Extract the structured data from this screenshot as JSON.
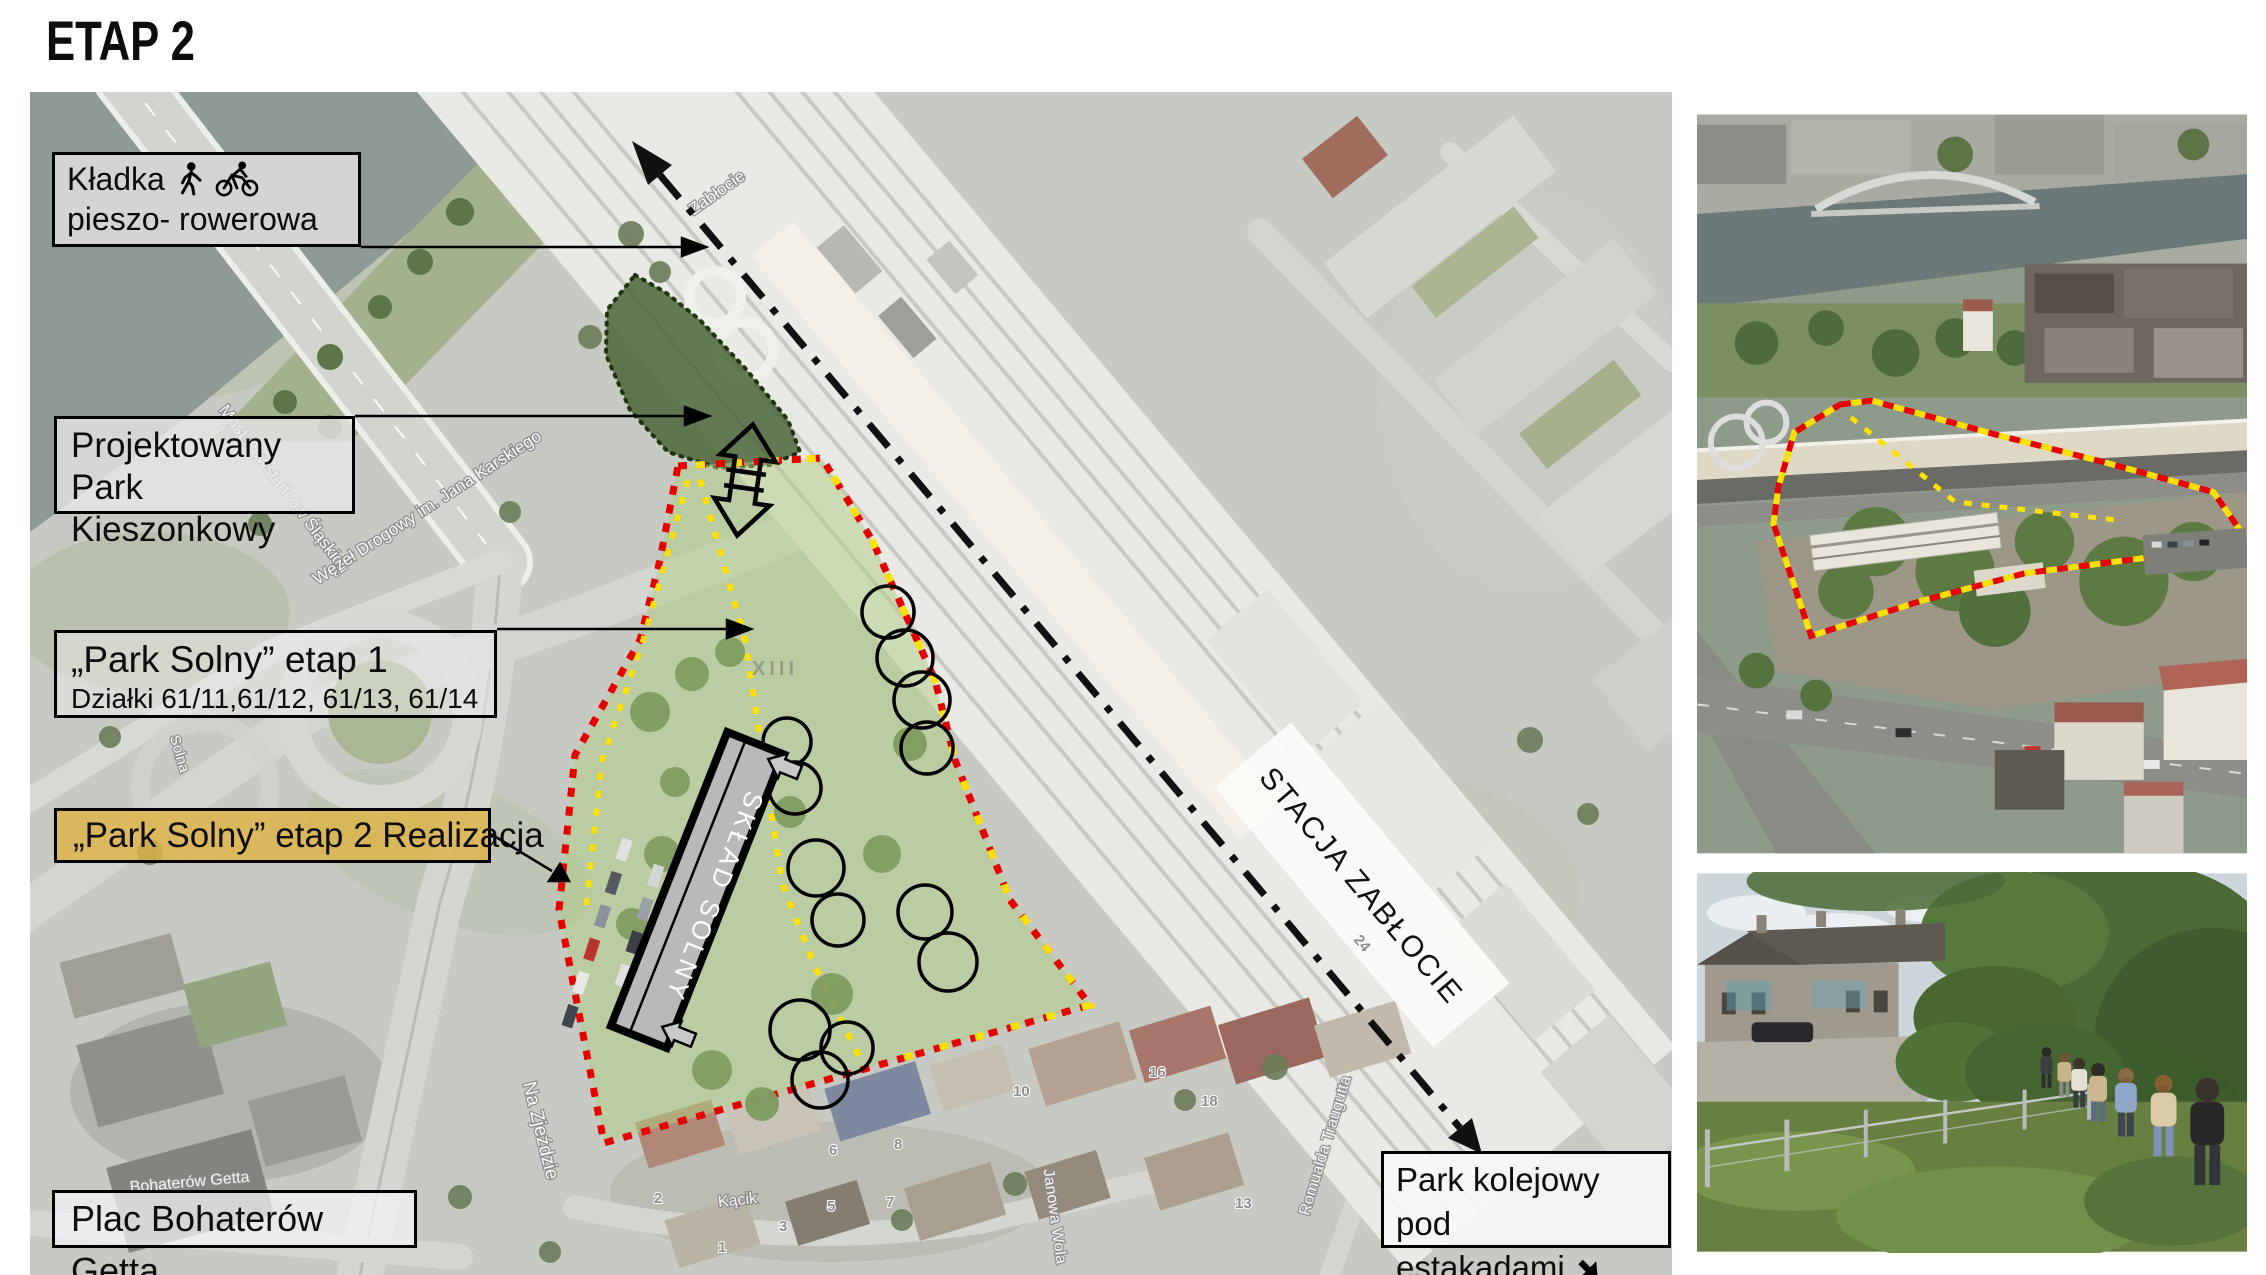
{
  "title": "ETAP 2",
  "map": {
    "labels": {
      "kladka": {
        "line1": "Kładka",
        "line2": "pieszo- rowerowa",
        "icons": [
          "pedestrian-icon",
          "cyclist-icon"
        ]
      },
      "pocket_park": {
        "line1": "Projektowany",
        "line2": "Park Kieszonkowy"
      },
      "etap1": {
        "line1": "„Park Solny” etap 1",
        "line2": "Działki 61/11,61/12, 61/13, 61/14"
      },
      "etap2": {
        "text": "„Park Solny” etap 2 Realizacja"
      },
      "plac": {
        "text": "Plac Bohaterów Getta"
      },
      "park_kolejowy": {
        "line1": "Park kolejowy pod",
        "line2": "estakadami",
        "icon": "southeast-arrow-icon"
      }
    },
    "station_label": "STACJA ZABŁOCIE",
    "building_label": "SKŁAD SOLNY",
    "zone_label": "XIII",
    "street_labels": [
      {
        "text": "Most Powstańców Śląskich"
      },
      {
        "text": "Węzeł Drogowy im. Jana Karskiego"
      },
      {
        "text": "Zabłocie"
      },
      {
        "text": "Na Zjeździe"
      },
      {
        "text": "Kącik"
      },
      {
        "text": "Romualda Traugutta"
      },
      {
        "text": "Janowa Wola"
      },
      {
        "text": "Bohaterów Getta"
      },
      {
        "text": "Solna"
      }
    ],
    "house_numbers": [
      {
        "t": "24"
      },
      {
        "t": "16"
      },
      {
        "t": "18"
      },
      {
        "t": "13"
      },
      {
        "t": "10"
      },
      {
        "t": "8"
      },
      {
        "t": "7"
      },
      {
        "t": "6"
      },
      {
        "t": "5"
      },
      {
        "t": "3"
      },
      {
        "t": "2"
      },
      {
        "t": "1"
      },
      {
        "t": "22"
      }
    ],
    "colors": {
      "boundary_red": "#e60000",
      "boundary_yellow": "#ffe100",
      "route_black": "#111111",
      "etap2_label_gold": "#ddb34a",
      "site_green_overlay": "rgba(176,205,130,0.5)",
      "pocket_park_green": "rgba(70,96,50,0.82)"
    }
  }
}
